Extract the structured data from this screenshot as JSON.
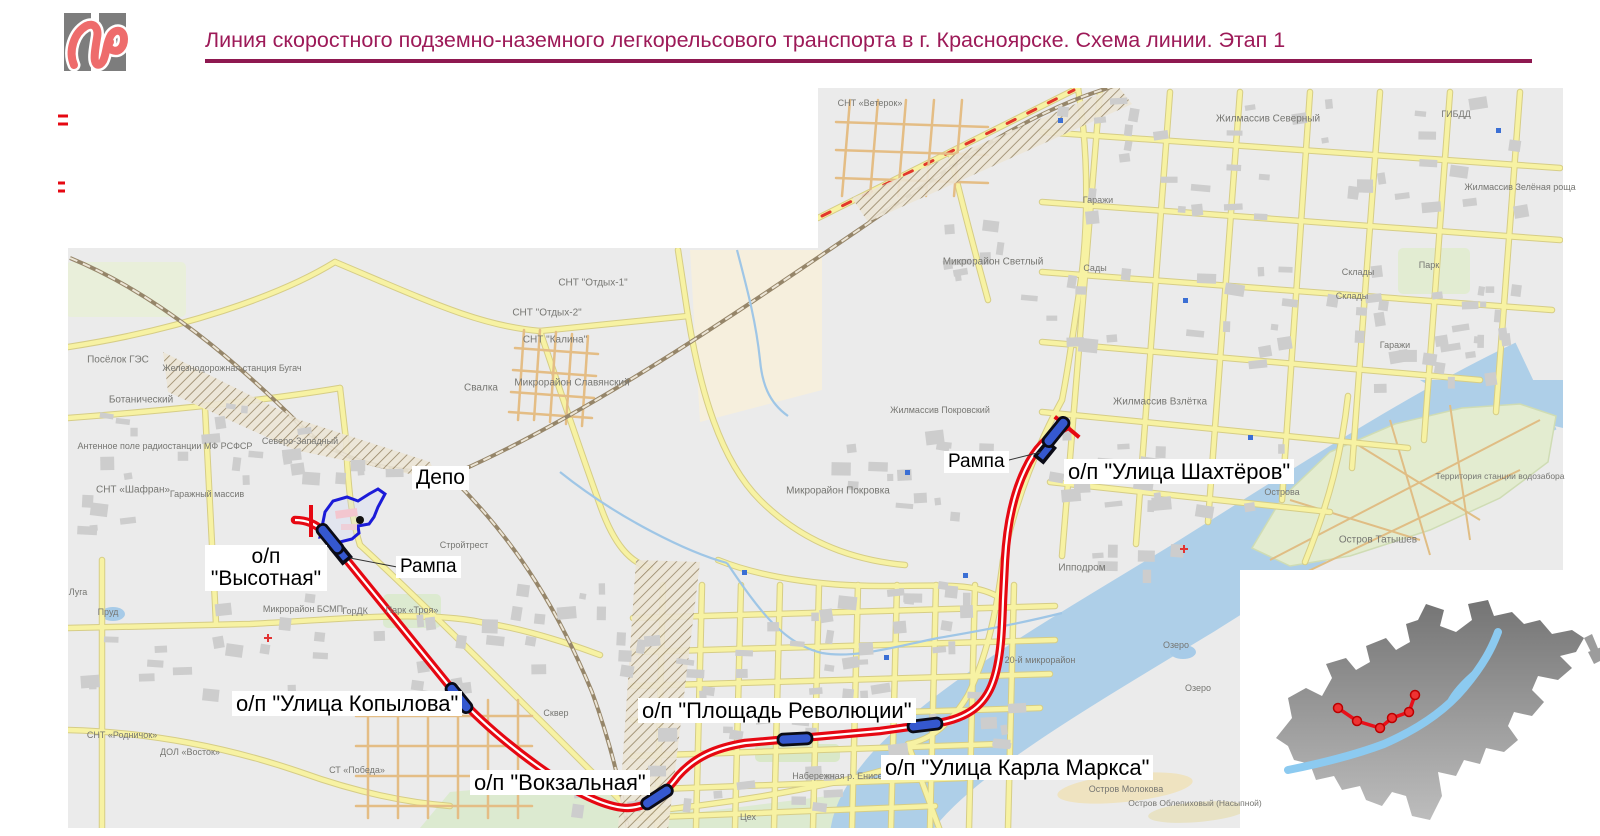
{
  "header": {
    "title": "Линия скоростного подземно-наземного легкорельсового транспорта в г. Красноярске. Схема линии. Этап 1"
  },
  "legend": {
    "heading": "Условные обозначения:",
    "items": [
      {
        "symbol": "underground-section",
        "text": "- подземный участок линии со станциями\n  (этап 1)"
      },
      {
        "symbol": "surface-section",
        "text": "- наземный участок линии с остановочными\n  пунктами (этап 1)"
      },
      {
        "symbol": "design-boundary",
        "text": "- граница проектирования этапа 1"
      }
    ]
  },
  "info_table": {
    "rows": [
      {
        "label": "Первая линия скоростного внеуличного транспорта:",
        "value": "Этап 1"
      },
      {
        "label": "Общ. длина линии, км",
        "value": "10,8"
      },
      {
        "label": "Подземные останов. пункты, шт.",
        "value": "4"
      },
      {
        "label": "Наземные останов. пункты, шт.",
        "value": "2"
      }
    ]
  },
  "map": {
    "station_labels": [
      {
        "id": "vysotnaya",
        "text": "о/п\n\"Высотная\"",
        "x": 205,
        "y": 545,
        "fs": 21,
        "w": 114,
        "align": "center"
      },
      {
        "id": "kopylova",
        "text": "о/п \"Улица Копылова\"",
        "x": 232,
        "y": 691,
        "fs": 22
      },
      {
        "id": "vokzalnaya",
        "text": "о/п \"Вокзальная\"",
        "x": 470,
        "y": 770,
        "fs": 22
      },
      {
        "id": "ploshchad-revolyutsii",
        "text": "о/п \"Площадь Революции\"",
        "x": 638,
        "y": 698,
        "fs": 22
      },
      {
        "id": "karla-marksa",
        "text": "о/п \"Улица Карла Маркса\"",
        "x": 881,
        "y": 755,
        "fs": 22
      },
      {
        "id": "shakhtyorov",
        "text": "о/п \"Улица Шахтёров\"",
        "x": 1064,
        "y": 459,
        "fs": 22
      },
      {
        "id": "depo",
        "text": "Депо",
        "x": 412,
        "y": 466,
        "fs": 21
      },
      {
        "id": "rampa-west",
        "text": "Рампа",
        "x": 396,
        "y": 556,
        "fs": 19
      },
      {
        "id": "rampa-east",
        "text": "Рампа",
        "x": 944,
        "y": 451,
        "fs": 19
      }
    ],
    "route": {
      "stations": [
        {
          "x": 330,
          "y": 539,
          "a": 51
        },
        {
          "x": 459,
          "y": 698,
          "a": 51
        },
        {
          "x": 657,
          "y": 797,
          "a": -33
        },
        {
          "x": 795,
          "y": 739,
          "a": -3
        },
        {
          "x": 925,
          "y": 725,
          "a": -7
        },
        {
          "x": 1056,
          "y": 432,
          "a": -51
        }
      ],
      "ramps": [
        {
          "x": 341,
          "y": 553,
          "a": 51
        },
        {
          "x": 1045,
          "y": 452,
          "a": -51
        }
      ],
      "boundaries": [
        {
          "x": 311,
          "y": 521,
          "a": 90
        },
        {
          "x": 1067,
          "y": 427,
          "a": 40
        }
      ]
    },
    "place_labels": [
      {
        "t": "СНТ «Ветерок»",
        "x": 870,
        "y": 103,
        "s": 9
      },
      {
        "t": "Микрорайон Светлый",
        "x": 993,
        "y": 262,
        "s": 10
      },
      {
        "t": "СНТ \"Отдых-1\"",
        "x": 593,
        "y": 283,
        "s": 10
      },
      {
        "t": "СНТ \"Отдых-2\"",
        "x": 547,
        "y": 313,
        "s": 10
      },
      {
        "t": "СНТ \"Калина\"",
        "x": 555,
        "y": 340,
        "s": 10
      },
      {
        "t": "Свалка",
        "x": 481,
        "y": 388,
        "s": 10
      },
      {
        "t": "Микрорайон Славянский",
        "x": 572,
        "y": 383,
        "s": 10
      },
      {
        "t": "Посёлок ГЭС",
        "x": 118,
        "y": 360,
        "s": 10
      },
      {
        "t": "Железнодорожная станция Бугач",
        "x": 232,
        "y": 368,
        "s": 9
      },
      {
        "t": "Ботанический",
        "x": 141,
        "y": 400,
        "s": 10
      },
      {
        "t": "Антенное поле радиостанции МФ РСФСР",
        "x": 165,
        "y": 446,
        "s": 9
      },
      {
        "t": "СНТ «Шафран»",
        "x": 133,
        "y": 490,
        "s": 10
      },
      {
        "t": "Гаражный массив",
        "x": 207,
        "y": 494,
        "s": 9
      },
      {
        "t": "Северо-Западный",
        "x": 300,
        "y": 441,
        "s": 9
      },
      {
        "t": "Стройтрест",
        "x": 464,
        "y": 545,
        "s": 9
      },
      {
        "t": "Микрорайон БСМП",
        "x": 303,
        "y": 609,
        "s": 9
      },
      {
        "t": "ГорДК",
        "x": 355,
        "y": 611,
        "s": 9
      },
      {
        "t": "Парк «Троя»",
        "x": 412,
        "y": 610,
        "s": 9
      },
      {
        "t": "Микрорайон Покровка",
        "x": 838,
        "y": 491,
        "s": 10
      },
      {
        "t": "Жилмассив Покровский",
        "x": 940,
        "y": 410,
        "s": 9
      },
      {
        "t": "Жилмассив Взлётка",
        "x": 1160,
        "y": 402,
        "s": 10
      },
      {
        "t": "Жилмассив Северный",
        "x": 1268,
        "y": 119,
        "s": 10
      },
      {
        "t": "Жилмассив Зелёная роща",
        "x": 1520,
        "y": 187,
        "s": 9
      },
      {
        "t": "ГИБДД",
        "x": 1456,
        "y": 114,
        "s": 9
      },
      {
        "t": "Гаражи",
        "x": 1098,
        "y": 200,
        "s": 9
      },
      {
        "t": "Гаражи",
        "x": 1395,
        "y": 345,
        "s": 9
      },
      {
        "t": "Склады",
        "x": 1358,
        "y": 272,
        "s": 9
      },
      {
        "t": "Склады",
        "x": 1352,
        "y": 296,
        "s": 9
      },
      {
        "t": "Сады",
        "x": 1095,
        "y": 268,
        "s": 9
      },
      {
        "t": "Парк",
        "x": 1429,
        "y": 265,
        "s": 9
      },
      {
        "t": "Ипподром",
        "x": 1082,
        "y": 568,
        "s": 10
      },
      {
        "t": "20-й микрорайон",
        "x": 1040,
        "y": 660,
        "s": 9
      },
      {
        "t": "Озеро",
        "x": 1176,
        "y": 645,
        "s": 9
      },
      {
        "t": "Озеро",
        "x": 1198,
        "y": 688,
        "s": 9
      },
      {
        "t": "Остров Татышев",
        "x": 1378,
        "y": 540,
        "s": 10
      },
      {
        "t": "Острова",
        "x": 1282,
        "y": 492,
        "s": 9
      },
      {
        "t": "Территория станции водозабора",
        "x": 1500,
        "y": 476,
        "s": 8.5
      },
      {
        "t": "Набережная р. Енисей",
        "x": 840,
        "y": 776,
        "s": 9
      },
      {
        "t": "Остров Молокова",
        "x": 1126,
        "y": 789,
        "s": 9
      },
      {
        "t": "Остров Облепиховый (Насыпной)",
        "x": 1195,
        "y": 803,
        "s": 8.5
      },
      {
        "t": "СТ «Победа»",
        "x": 357,
        "y": 770,
        "s": 9
      },
      {
        "t": "ДОЛ «Восток»",
        "x": 190,
        "y": 752,
        "s": 9
      },
      {
        "t": "СНТ «Родничок»",
        "x": 122,
        "y": 735,
        "s": 9
      },
      {
        "t": "Пруд",
        "x": 108,
        "y": 612,
        "s": 9
      },
      {
        "t": "Луга",
        "x": 78,
        "y": 592,
        "s": 9
      },
      {
        "t": "Сквер",
        "x": 556,
        "y": 713,
        "s": 9
      },
      {
        "t": "Цех",
        "x": 748,
        "y": 817,
        "s": 9
      }
    ]
  },
  "colors": {
    "accent": "#9d1a58",
    "route_red": "#e60812",
    "station_blue": "#3558cf",
    "depot_outline": "#1b1bd8",
    "water": "#aecfe8",
    "road_yellow": "#f7f2a3"
  }
}
